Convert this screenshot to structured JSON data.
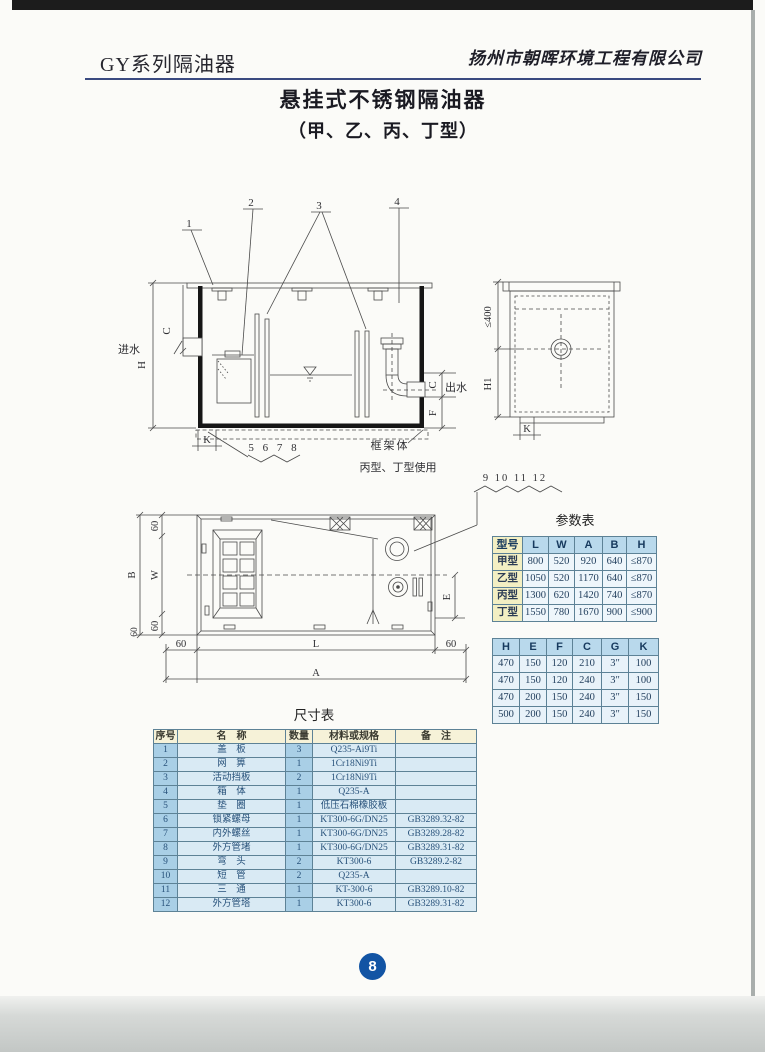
{
  "header": {
    "series": "GY系列隔油器",
    "company": "扬州市朝晖环境工程有限公司"
  },
  "title_block": {
    "title": "悬挂式不锈钢隔油器",
    "subtitle": "（甲、乙、丙、丁型）"
  },
  "drawings": {
    "side_view": {
      "callout_1": "1",
      "callout_2": "2",
      "callout_3": "3",
      "callout_4": "4",
      "inlet_label": "进水",
      "outlet_label": "出水",
      "dim_h": "H",
      "dim_c_in": "C",
      "dim_c_out": "C",
      "dim_f": "F",
      "dim_k": "K",
      "group_label": "5 6 7 8",
      "frame_label": "框架体",
      "frame_note": "丙型、丁型使用"
    },
    "end_view": {
      "dim_max": "≤400",
      "dim_h1": "H1",
      "dim_k": "K"
    },
    "plan_view": {
      "callouts": "9 10 11 12",
      "dim_60_top": "60",
      "dim_w": "W",
      "dim_b": "B",
      "dim_60_bottom": "60",
      "dim_60_corner": "60",
      "dim_60_left": "60",
      "dim_l": "L",
      "dim_60_right": "60",
      "dim_a": "A",
      "dim_e": "E"
    }
  },
  "param_table": {
    "title": "参数表",
    "headers": [
      "型号",
      "L",
      "W",
      "A",
      "B",
      "H"
    ],
    "rows": [
      [
        "甲型",
        "800",
        "520",
        "920",
        "640",
        "≤870"
      ],
      [
        "乙型",
        "1050",
        "520",
        "1170",
        "640",
        "≤870"
      ],
      [
        "丙型",
        "1300",
        "620",
        "1420",
        "740",
        "≤870"
      ],
      [
        "丁型",
        "1550",
        "780",
        "1670",
        "900",
        "≤900"
      ]
    ]
  },
  "param_table2": {
    "headers": [
      "H",
      "E",
      "F",
      "C",
      "G",
      "K"
    ],
    "rows": [
      [
        "470",
        "150",
        "120",
        "210",
        "3″",
        "100"
      ],
      [
        "470",
        "150",
        "120",
        "240",
        "3″",
        "100"
      ],
      [
        "470",
        "200",
        "150",
        "240",
        "3″",
        "150"
      ],
      [
        "500",
        "200",
        "150",
        "240",
        "3″",
        "150"
      ]
    ]
  },
  "size_table": {
    "title": "尺寸表",
    "headers": [
      "序号",
      "名　称",
      "数量",
      "材料或规格",
      "备　注"
    ],
    "rows": [
      [
        "1",
        "盖　板",
        "3",
        "Q235-Ai9Ti",
        ""
      ],
      [
        "2",
        "网　箅",
        "1",
        "1Cr18Ni9Ti",
        ""
      ],
      [
        "3",
        "活动挡板",
        "2",
        "1Cr18Ni9Ti",
        ""
      ],
      [
        "4",
        "箱　体",
        "1",
        "Q235-A",
        ""
      ],
      [
        "5",
        "垫　圈",
        "1",
        "低压石棉橡胶板",
        ""
      ],
      [
        "6",
        "锁紧螺母",
        "1",
        "KT300-6G/DN25",
        "GB3289.32-82"
      ],
      [
        "7",
        "内外螺丝",
        "1",
        "KT300-6G/DN25",
        "GB3289.28-82"
      ],
      [
        "8",
        "外方管堵",
        "1",
        "KT300-6G/DN25",
        "GB3289.31-82"
      ],
      [
        "9",
        "弯　头",
        "2",
        "KT300-6",
        "GB3289.2-82"
      ],
      [
        "10",
        "短　管",
        "2",
        "Q235-A",
        ""
      ],
      [
        "11",
        "三　通",
        "1",
        "KT-300-6",
        "GB3289.10-82"
      ],
      [
        "12",
        "外方管塔",
        "1",
        "KT300-6",
        "GB3289.31-82"
      ]
    ]
  },
  "footer": {
    "page_number": "8"
  },
  "colors": {
    "table_header_blue": "#b9d9ec",
    "model_col_yellow": "#f3efc3",
    "cell_blue_light": "#d9eaf4",
    "cell_blue_mid": "#a9cfe6",
    "header_cream": "#f6f2d8",
    "page_circle_blue": "#1254a4",
    "rule_navy": "#3a4a80"
  }
}
